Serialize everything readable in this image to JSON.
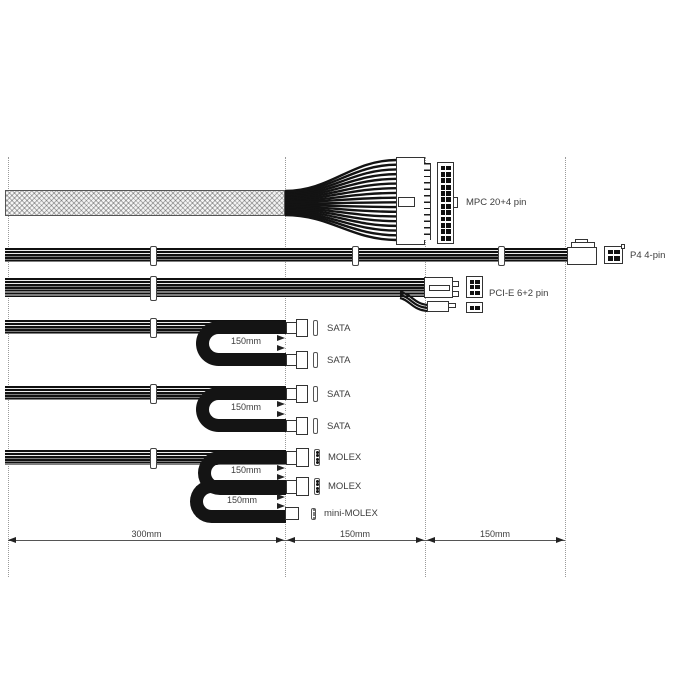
{
  "title": "PSU cable length diagram",
  "colors": {
    "cable": "#141414",
    "outline": "#333333",
    "text": "#3d3d3d",
    "dotted_guide": "#9a9a9a",
    "braid_fill": "#f4f4f4"
  },
  "cables": {
    "atx": {
      "connector_label": "MPC 20+4 pin"
    },
    "p4": {
      "connector_label": "P4 4-pin"
    },
    "pcie": {
      "connector_label": "PCI-E 6+2 pin"
    },
    "sata_group1": {
      "connectors": [
        "SATA",
        "SATA"
      ],
      "loop_length": "150mm"
    },
    "sata_group2": {
      "connectors": [
        "SATA",
        "SATA"
      ],
      "loop_length": "150mm"
    },
    "molex_group": {
      "connectors": [
        "MOLEX",
        "MOLEX",
        "mini-MOLEX"
      ],
      "loop_lengths": [
        "150mm",
        "150mm"
      ]
    }
  },
  "dimensions": {
    "segments": [
      "300mm",
      "150mm",
      "150mm"
    ]
  }
}
